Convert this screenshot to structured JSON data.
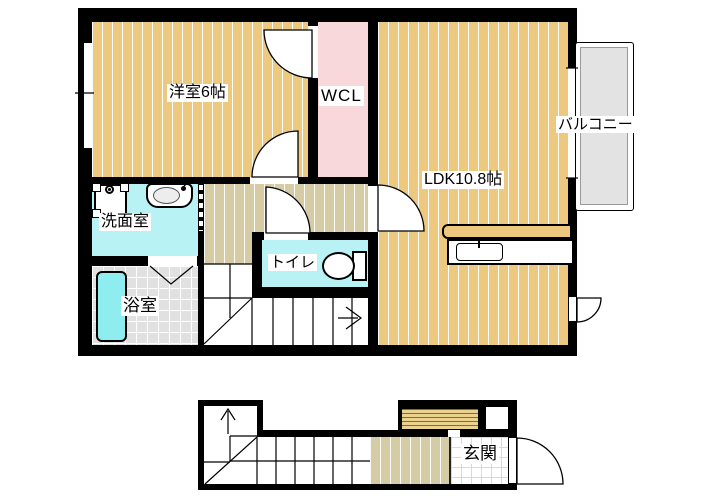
{
  "title": "マンション間取り図",
  "colors": {
    "wall": "#000000",
    "wood": "#ECC97E",
    "hall": "#D5CCA5",
    "wcl_pink": "#F8D8DB",
    "wet_cyan": "#B8F2F4",
    "tub_cyan": "#8FEDEF",
    "tile_gray": "#E1E1E1",
    "balcony_gray": "#E3E3E3",
    "cabinet_tan": "#ECD28F",
    "cabinet_line": "#7A6A45"
  },
  "rooms": {
    "yoshitsu": {
      "label": "洋室6帖"
    },
    "wcl": {
      "label": "WCL"
    },
    "ldk": {
      "label": "LDK10.8帖"
    },
    "balcony": {
      "label": "バルコニー"
    },
    "senmen": {
      "label": "洗面室"
    },
    "toilet": {
      "label": "トイレ"
    },
    "bath": {
      "label": "浴室"
    },
    "genkan": {
      "label": "玄関"
    }
  }
}
